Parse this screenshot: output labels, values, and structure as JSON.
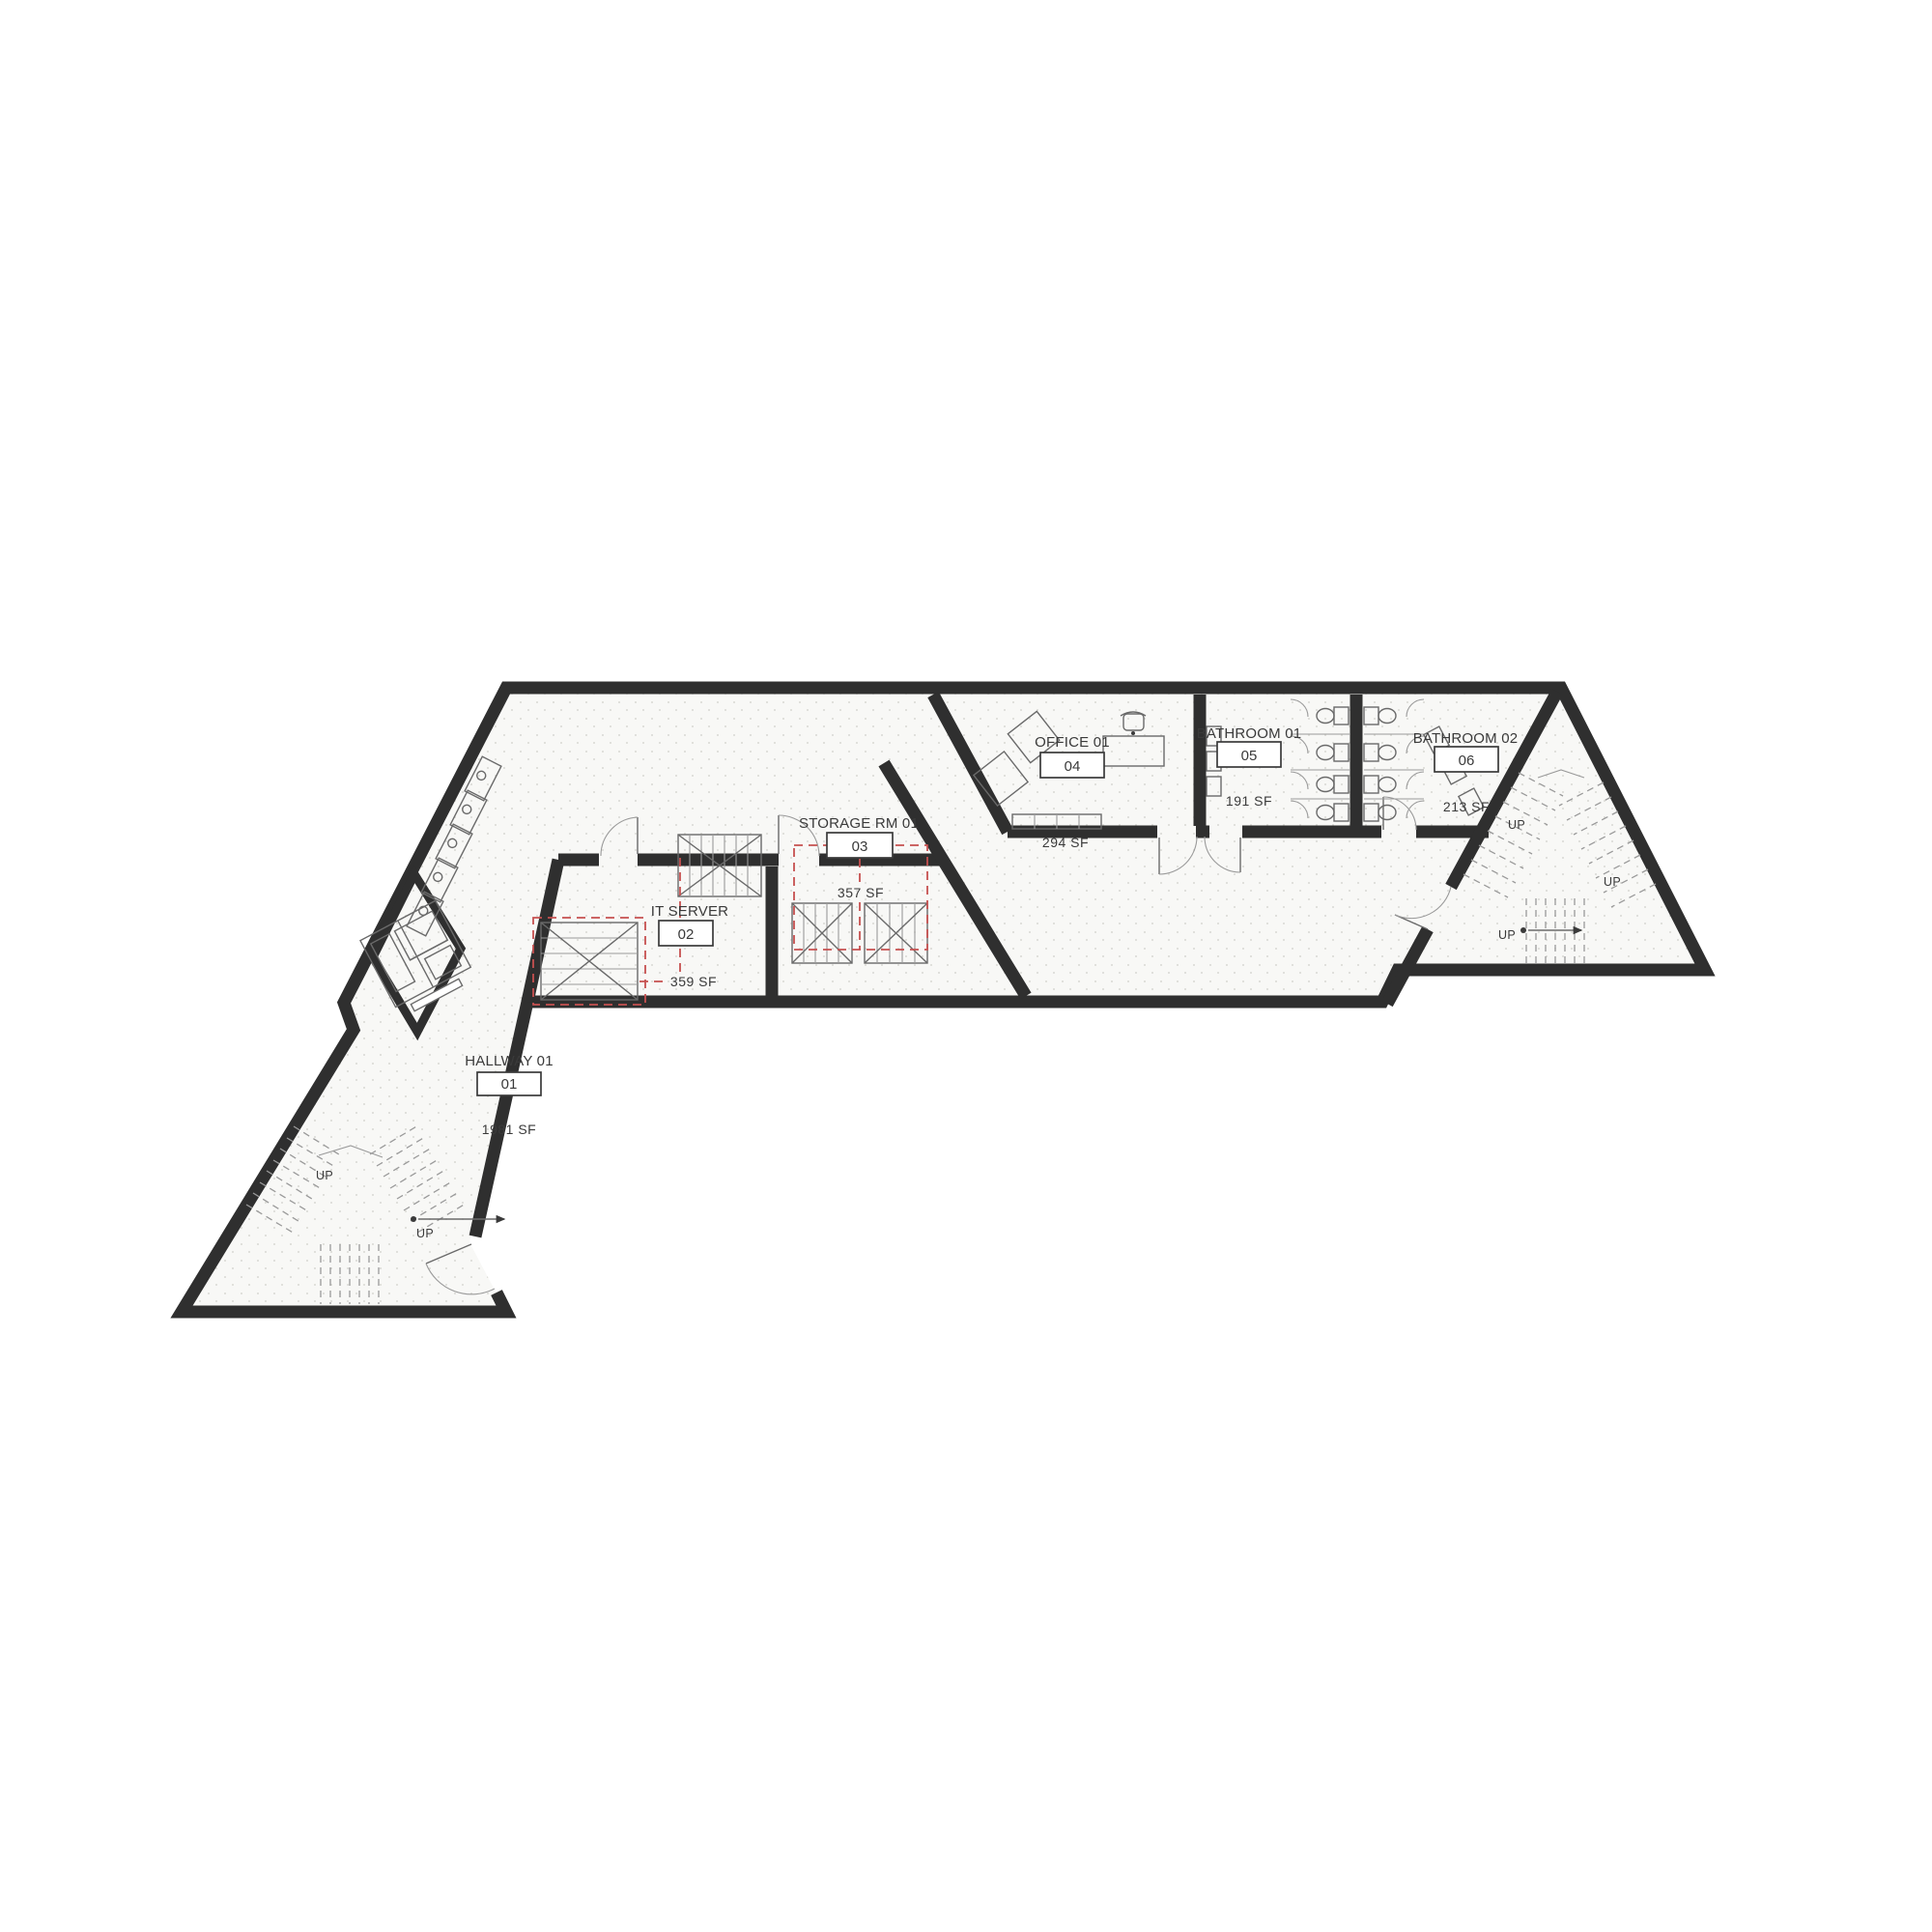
{
  "plan": {
    "type": "architectural-floor-plan",
    "rooms": [
      {
        "name": "HALLWAY 01",
        "id": "01",
        "area": "1981 SF"
      },
      {
        "name": "IT SERVER",
        "id": "02",
        "area": "359 SF"
      },
      {
        "name": "STORAGE RM 01",
        "id": "03",
        "area": "357 SF"
      },
      {
        "name": "OFFICE 01",
        "id": "04",
        "area": "294 SF"
      },
      {
        "name": "BATHROOM 01",
        "id": "05",
        "area": "191 SF"
      },
      {
        "name": "BATHROOM 02",
        "id": "06",
        "area": "213 SF"
      }
    ],
    "stair_label": "UP"
  },
  "labels": {
    "up": "UP"
  },
  "colors": {
    "wall": "#2f2f2f",
    "floor": "#f8f8f6",
    "floor_dot": "#d9d9d3",
    "annotation_red": "#c65050",
    "line": "#6a6a6a",
    "thin": "#9a9a9a",
    "text": "#3a3a3a"
  }
}
